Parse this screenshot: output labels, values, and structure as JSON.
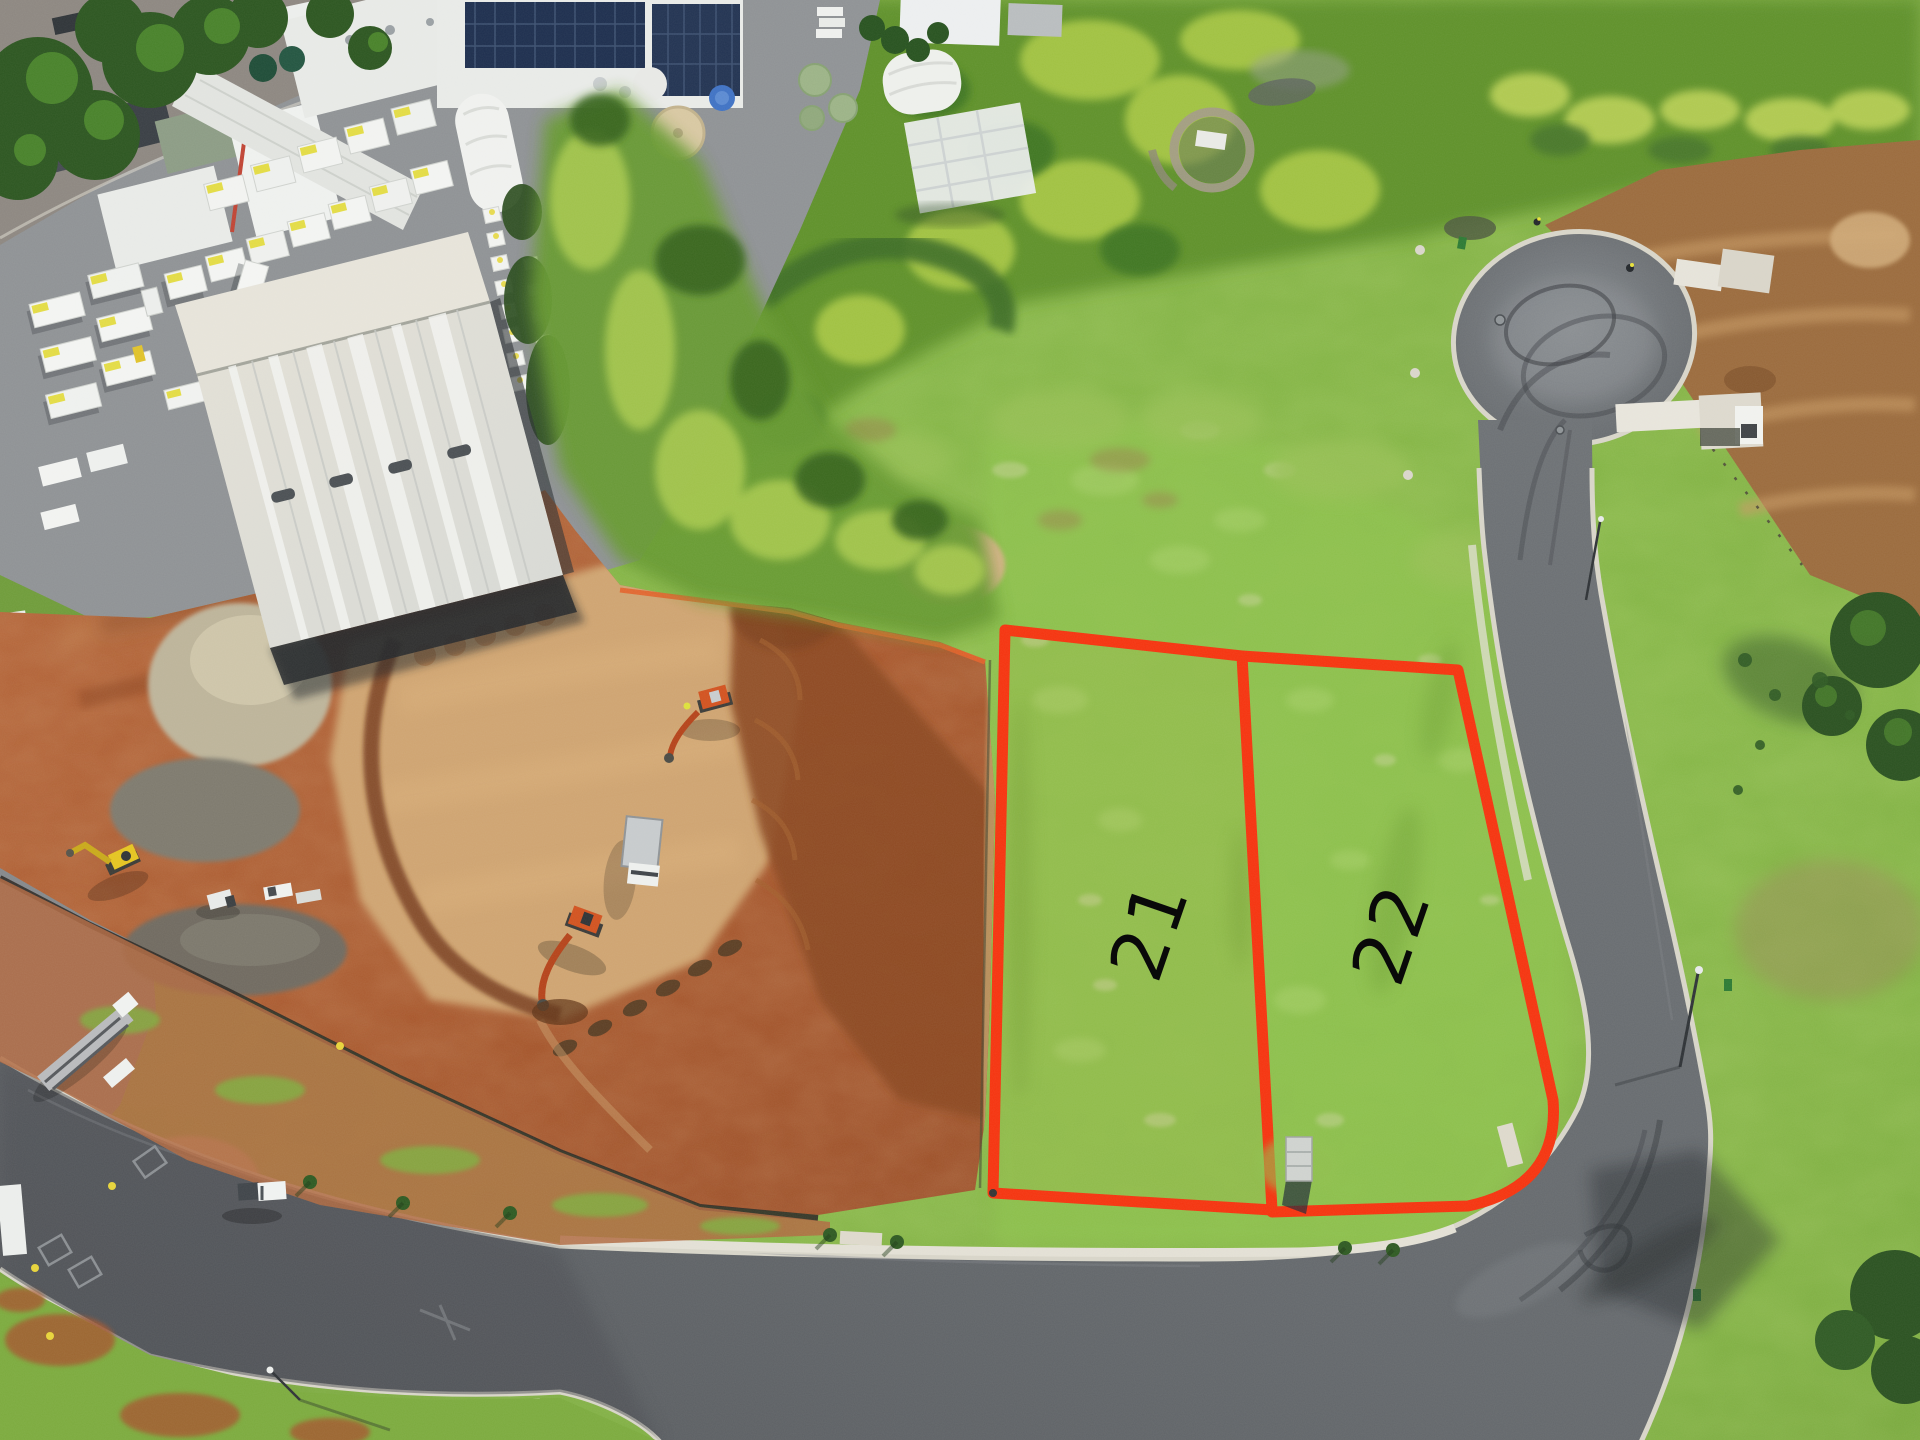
{
  "annotations": {
    "outline_color": "#f5330e",
    "lots": [
      {
        "id": "lot-21",
        "label": "21"
      },
      {
        "id": "lot-22",
        "label": "22"
      }
    ]
  },
  "palette": {
    "grass": "#7fb23f",
    "scrub": "#5f9129",
    "earthworks_dirt": "#a8572c",
    "pale_cut_ground": "#cfa471",
    "asphalt": "#5f6367",
    "kerb_concrete": "#d8d5c9",
    "roof_white": "#e9ebe8",
    "roof_cream": "#e6e3da",
    "solar_panel": "#1d2e4e",
    "machine_orange": "#d2521f",
    "machine_yellow": "#e5c520",
    "label_text": "#090909"
  }
}
